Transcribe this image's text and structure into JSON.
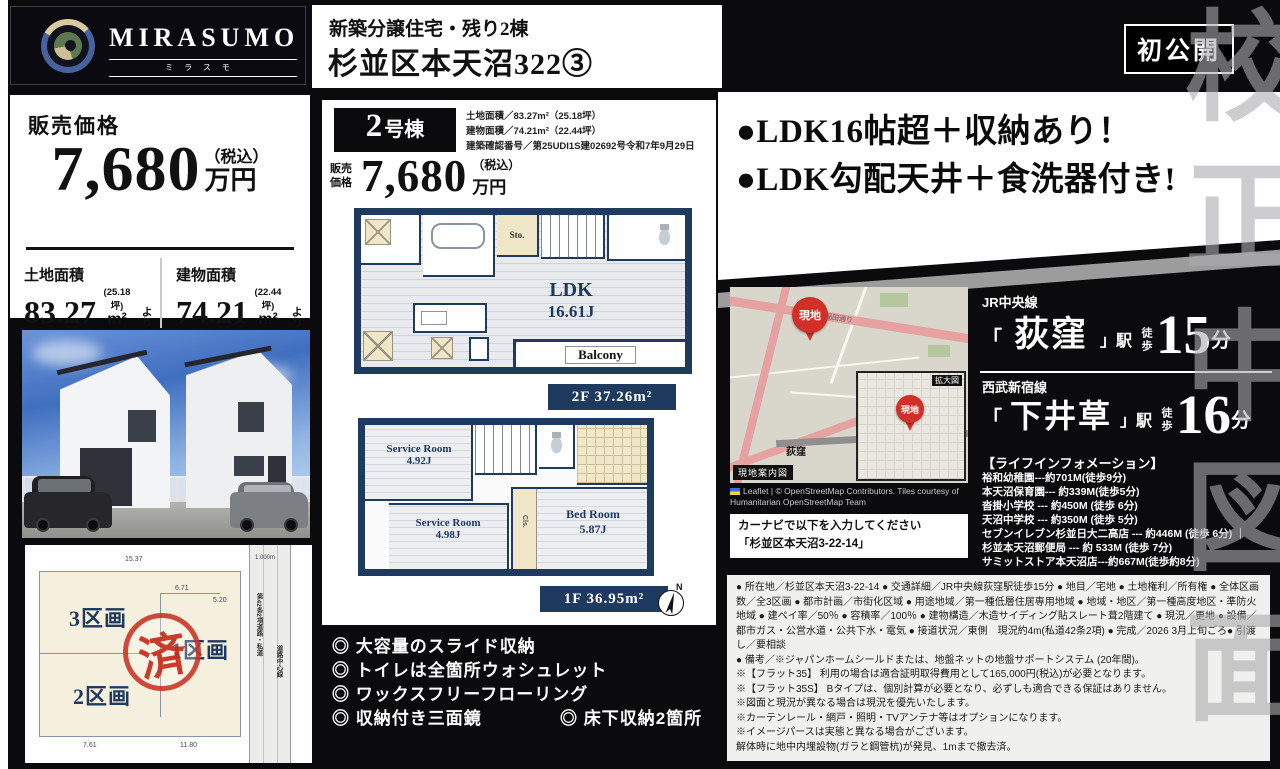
{
  "watermark": "校正中図面",
  "header": {
    "brand": "MIRASUMO",
    "brand_kana": "ミラスモ",
    "title_line1": "新築分譲住宅・残り2棟",
    "title_line2": "杉並区本天沼322③",
    "badge": "初公開"
  },
  "price_panel": {
    "label": "販売価格",
    "amount": "7,680",
    "tax_note": "（税込）",
    "unit": "万円",
    "land_label": "土地面積",
    "land_value": "83.27",
    "land_tsubo": "(25.18坪)",
    "land_unit": "m²",
    "land_suffix": "より",
    "bldg_label": "建物面積",
    "bldg_value": "74.21",
    "bldg_tsubo": "(22.44坪)",
    "bldg_unit": "m²",
    "bldg_suffix": "より"
  },
  "plan_panel": {
    "unit_no": "2",
    "unit_suffix": "号棟",
    "spec1": "土地面積／83.27m²（25.18坪）",
    "spec2": "建物面積／74.21m²（22.44坪）",
    "spec3": "建築確認番号／第25UDI1S建02692号令和7年9月29日",
    "price_label": "販売価格",
    "amount": "7,680",
    "tax_note": "（税込）",
    "unit": "万円",
    "f2": {
      "ldk": "LDK",
      "ldk_size": "16.61J",
      "sto": "Sto.",
      "balcony": "Balcony",
      "area": "2F 37.26m²"
    },
    "f1": {
      "sr1": "Service Room",
      "sr1_size": "4.92J",
      "sr2": "Service Room",
      "sr2_size": "4.98J",
      "bed": "Bed Room",
      "bed_size": "5.87J",
      "cls": "Cls.",
      "area": "1F 36.95m²",
      "north": "N"
    }
  },
  "features": [
    "◎ 大容量のスライド収納",
    "◎ トイレは全箇所ウォシュレット",
    "◎ ワックスフリーフローリング",
    "◎ 収納付き三面鏡",
    "◎ 床下収納2箇所"
  ],
  "highlights": [
    "●LDK16帖超＋収納あり！",
    "●LDK勾配天井＋食洗器付き!"
  ],
  "map": {
    "pin": "現地",
    "inset_label": "拡大図",
    "guide_label": "現地案内図",
    "road_label": "早稲田通り",
    "station_label": "荻窪",
    "attribution1": "Leaflet | © OpenStreetMap Contributors. Tiles courtesy of",
    "attribution2": "Humanitarian OpenStreetMap Team",
    "navi_line1": "カーナビで以下を入力してください",
    "navi_line2": "「杉並区本天沼3-22-14」"
  },
  "access": {
    "line1": {
      "railway": "JR中央線",
      "open": "「",
      "station": "荻窪",
      "close": "」駅",
      "walk": "徒歩",
      "minutes": "15",
      "unit": "分"
    },
    "line2": {
      "railway": "西武新宿線",
      "open": "「",
      "station": "下井草",
      "close": "」駅",
      "walk": "徒歩",
      "minutes": "16",
      "unit": "分"
    }
  },
  "life_info": {
    "title": "【ライフインフォメーション】",
    "items": [
      "裕和幼稚園---約701M(徒歩9分)",
      "本天沼保育園--- 約339M(徒歩5分)",
      "沓掛小学校 --- 約450M (徒歩 6分)",
      "天沼中学校 --- 約350M (徒歩 5分)",
      "セブンイレブン杉並日大二高店 --- 約446M (徒歩 6分) ｜",
      "杉並本天沼郵便局 --- 約 533M (徒歩 7分)",
      "サミットストア本天沼店---約667M(徒歩約8分)"
    ]
  },
  "details": {
    "para": "● 所在地／杉並区本天沼3-22-14 ● 交通詳細／JR中央線荻窪駅徒歩15分 ● 地目／宅地 ● 土地権利／所有権 ● 全体区画数／全3区画 ● 都市計画／市街化区域 ● 用途地域／第一種低層住居専用地域 ● 地域・地区／第一種高度地区・準防火地域 ● 建ペイ率／50％ ● 容積率／100％ ● 建物構造／木造サイディング貼スレート葺2階建て ● 現況／更地 ● 設備／都市ガス・公営水道・公共下水・電気 ● 接道状況／東側　現況約4m(私道42条2項) ● 完成／2026 3月上旬ごろ● 引渡し／要相談",
    "note1": "● 備考／※ジャパンホームシールドまたは、地盤ネットの地盤サポートシステム (20年間)。",
    "note2": "※【フラット35】 利用の場合は適合証明取得費用として165,000円(税込)が必要となります。",
    "note3": "※【フラット35S】 Bタイプは、個別計算が必要となり、必ずしも適合できる保証はありません。",
    "note4": "※図面と現況が異なる場合は現況を優先いたします。",
    "note5": "※カーテンレール・網戸・照明・TVアンテナ等はオプションになります。",
    "note6": "※イメージパースは実態と異なる場合がございます。",
    "note7": "解体時に地中内埋設物(ガラと鋼管杭)が発見、1mまで撤去済。"
  },
  "plot": {
    "p3": "3区画",
    "p2": "2区画",
    "p1": "1区画",
    "stamp": "済",
    "road1": "第42条2項道路・私道",
    "road2": "道路中心線",
    "dim_top": "15.37",
    "dim_b1": "7.61",
    "dim_b2": "11.80",
    "dim_r": "1.000m",
    "dim_m1": "6.71",
    "dim_m2": "5.20"
  }
}
